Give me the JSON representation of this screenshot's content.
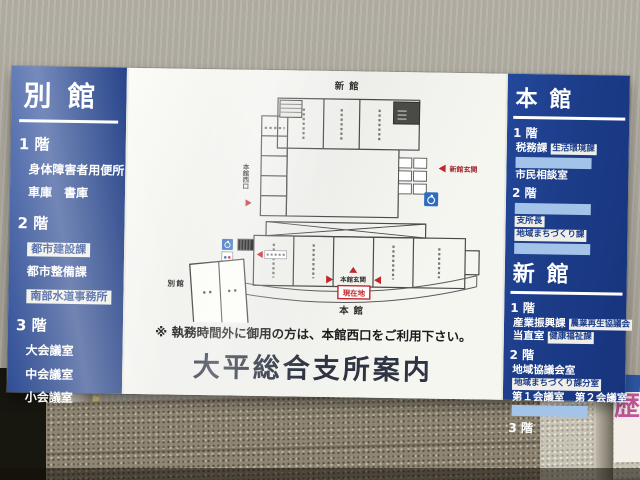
{
  "sign": {
    "title": "大平総合支所案内",
    "notice": "※ 執務時間外に御用の方は、本館西口をご利用下さい。"
  },
  "left_panel": {
    "header": "別館",
    "floors": [
      {
        "floor": "1 階",
        "items": [
          {
            "t": "身体障害者用便所",
            "style": "plain"
          },
          {
            "t": "車庫　書庫",
            "style": "plain"
          }
        ]
      },
      {
        "floor": "2 階",
        "items": [
          {
            "t": "都市建設課",
            "style": "box"
          },
          {
            "t": "都市整備課",
            "style": "plain"
          },
          {
            "t": "南部水道事務所",
            "style": "box"
          }
        ]
      },
      {
        "floor": "3 階",
        "items": [
          {
            "t": "大会議室",
            "style": "plain"
          },
          {
            "t": "中会議室",
            "style": "plain"
          },
          {
            "t": "小会議室",
            "style": "plain"
          }
        ]
      }
    ]
  },
  "right_panel": {
    "buildings": [
      {
        "header": "本館",
        "floors": [
          {
            "floor": "1 階",
            "rows": [
              {
                "cells": [
                  {
                    "t": "税務課",
                    "style": "plain"
                  },
                  {
                    "t": "生活環境課",
                    "style": "box"
                  }
                ]
              },
              {
                "cells": [
                  {
                    "t": "",
                    "style": "blank"
                  }
                ]
              },
              {
                "cells": [
                  {
                    "t": "市民相談室",
                    "style": "plain"
                  }
                ]
              }
            ]
          },
          {
            "floor": "2 階",
            "rows": [
              {
                "cells": [
                  {
                    "t": "",
                    "style": "blank"
                  }
                ]
              },
              {
                "cells": [
                  {
                    "t": "支所長",
                    "style": "box"
                  }
                ]
              },
              {
                "cells": [
                  {
                    "t": "地域まちづくり課",
                    "style": "box"
                  }
                ]
              },
              {
                "cells": [
                  {
                    "t": "",
                    "style": "blank"
                  }
                ]
              }
            ]
          }
        ]
      },
      {
        "header": "新館",
        "floors": [
          {
            "floor": "1 階",
            "rows": [
              {
                "cells": [
                  {
                    "t": "産業振興課",
                    "style": "plain"
                  },
                  {
                    "t": "農業再生協議会",
                    "style": "box"
                  }
                ]
              },
              {
                "cells": [
                  {
                    "t": "当直室",
                    "style": "plain"
                  },
                  {
                    "t": "健康福祉課",
                    "style": "box"
                  }
                ]
              }
            ]
          },
          {
            "floor": "2 階",
            "rows": [
              {
                "cells": [
                  {
                    "t": "地域協議会室",
                    "style": "plain"
                  }
                ]
              },
              {
                "cells": [
                  {
                    "t": "地域まちづくり課分室",
                    "style": "box"
                  }
                ]
              },
              {
                "cells": [
                  {
                    "t": "第１会議室　第２会議室",
                    "style": "plain"
                  }
                ]
              },
              {
                "cells": [
                  {
                    "t": "",
                    "style": "blank"
                  }
                ]
              }
            ]
          },
          {
            "floor": "3 階",
            "rows": []
          }
        ]
      }
    ]
  },
  "floor_plan": {
    "new_wing": "新館",
    "new_entrance": "新館玄関",
    "main_entrance": "本館玄関",
    "you_are_here": "現在地",
    "main_wing": "本館",
    "annex": "別館",
    "west_exit": "本館西口"
  },
  "surroundings": {
    "poster_char": "歴"
  },
  "colors": {
    "panel_blue": "#1d3c88",
    "label_box_white": "#efefe8",
    "blank_label_blue": "#a3c3e8",
    "accent_red": "#c0272d",
    "accessible_blue": "#2f6bbf",
    "title_navy": "#2e3443"
  }
}
